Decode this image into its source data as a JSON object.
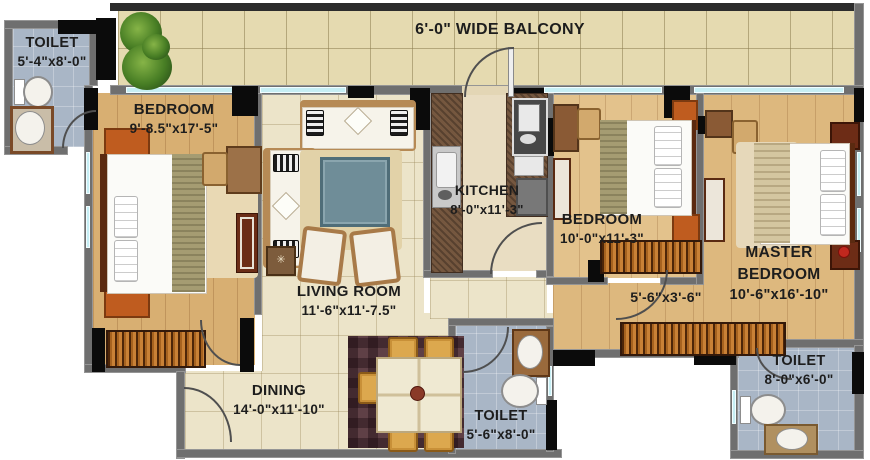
{
  "balcony": {
    "label": "6'-0\" WIDE BALCONY"
  },
  "rooms": {
    "toilet_top_left": {
      "name": "TOILET",
      "dims": "5'-4\"x8'-0\""
    },
    "bedroom_left": {
      "name": "BEDROOM",
      "dims": "9'-8.5\"x17'-5\""
    },
    "living_room": {
      "name": "LIVING ROOM",
      "dims": "11'-6\"x11'-7.5\""
    },
    "kitchen": {
      "name": "KITCHEN",
      "dims": "8'-0\"x11'-3\""
    },
    "bedroom_middle": {
      "name": "BEDROOM",
      "dims": "10'-0\"x11'-3\""
    },
    "master_bedroom": {
      "name_line1": "MASTER",
      "name_line2": "BEDROOM",
      "dims": "10'-6\"x16'-10\""
    },
    "passage": {
      "dims": "5'-6\"x3'-6\""
    },
    "dining": {
      "name": "DINING",
      "dims": "14'-0\"x11'-10\""
    },
    "toilet_middle": {
      "name": "TOILET",
      "dims": "5'-6\"x8'-0\""
    },
    "toilet_right": {
      "name": "TOILET",
      "dims": "8'-0\"x6'-0\""
    }
  },
  "colors": {
    "wall": "#6f6f6f",
    "column": "#0b0b0b",
    "window_glass": "#c6eef4",
    "balcony_tile": "#e5dab0",
    "wood_floor": "#d8af72",
    "tile_floor": "#ece4c9",
    "toilet_tile": "#a9b6c6",
    "wardrobe": "#b5702f",
    "label_text": "#1d1d1d"
  }
}
